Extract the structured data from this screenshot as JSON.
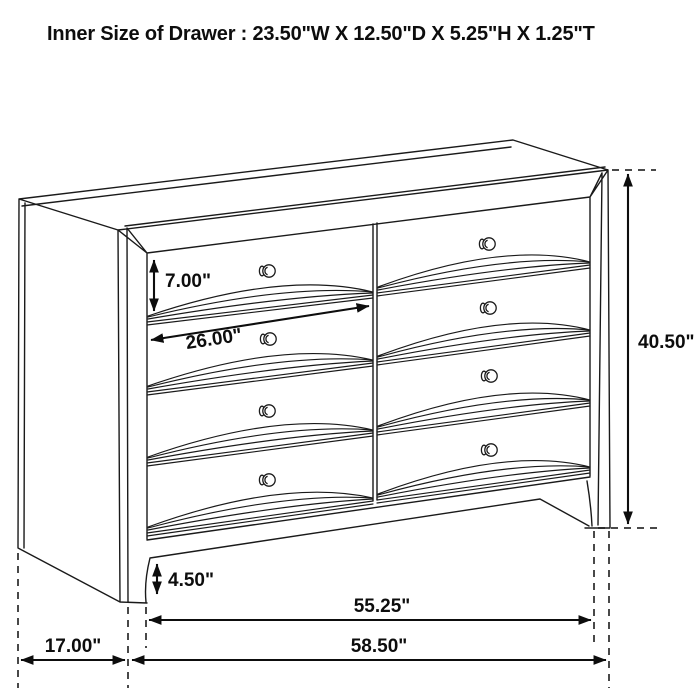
{
  "title": "Inner Size of Drawer : 23.50\"W X 12.50\"D X 5.25\"H X 1.25\"T",
  "product": {
    "item": "eight-drawer dresser line drawing",
    "drawer_rows": 4,
    "drawer_columns": 2,
    "knob_count": 8
  },
  "dimensions": {
    "drawer_face_height": "7.00\"",
    "drawer_face_width": "26.00\"",
    "overall_height": "40.50\"",
    "leg_height": "4.50\"",
    "base_width": "55.25\"",
    "side_depth": "17.00\"",
    "overall_width": "58.50\""
  },
  "colors": {
    "line": "#1a1a1a",
    "text": "#0d0d0d",
    "background": "#ffffff"
  }
}
